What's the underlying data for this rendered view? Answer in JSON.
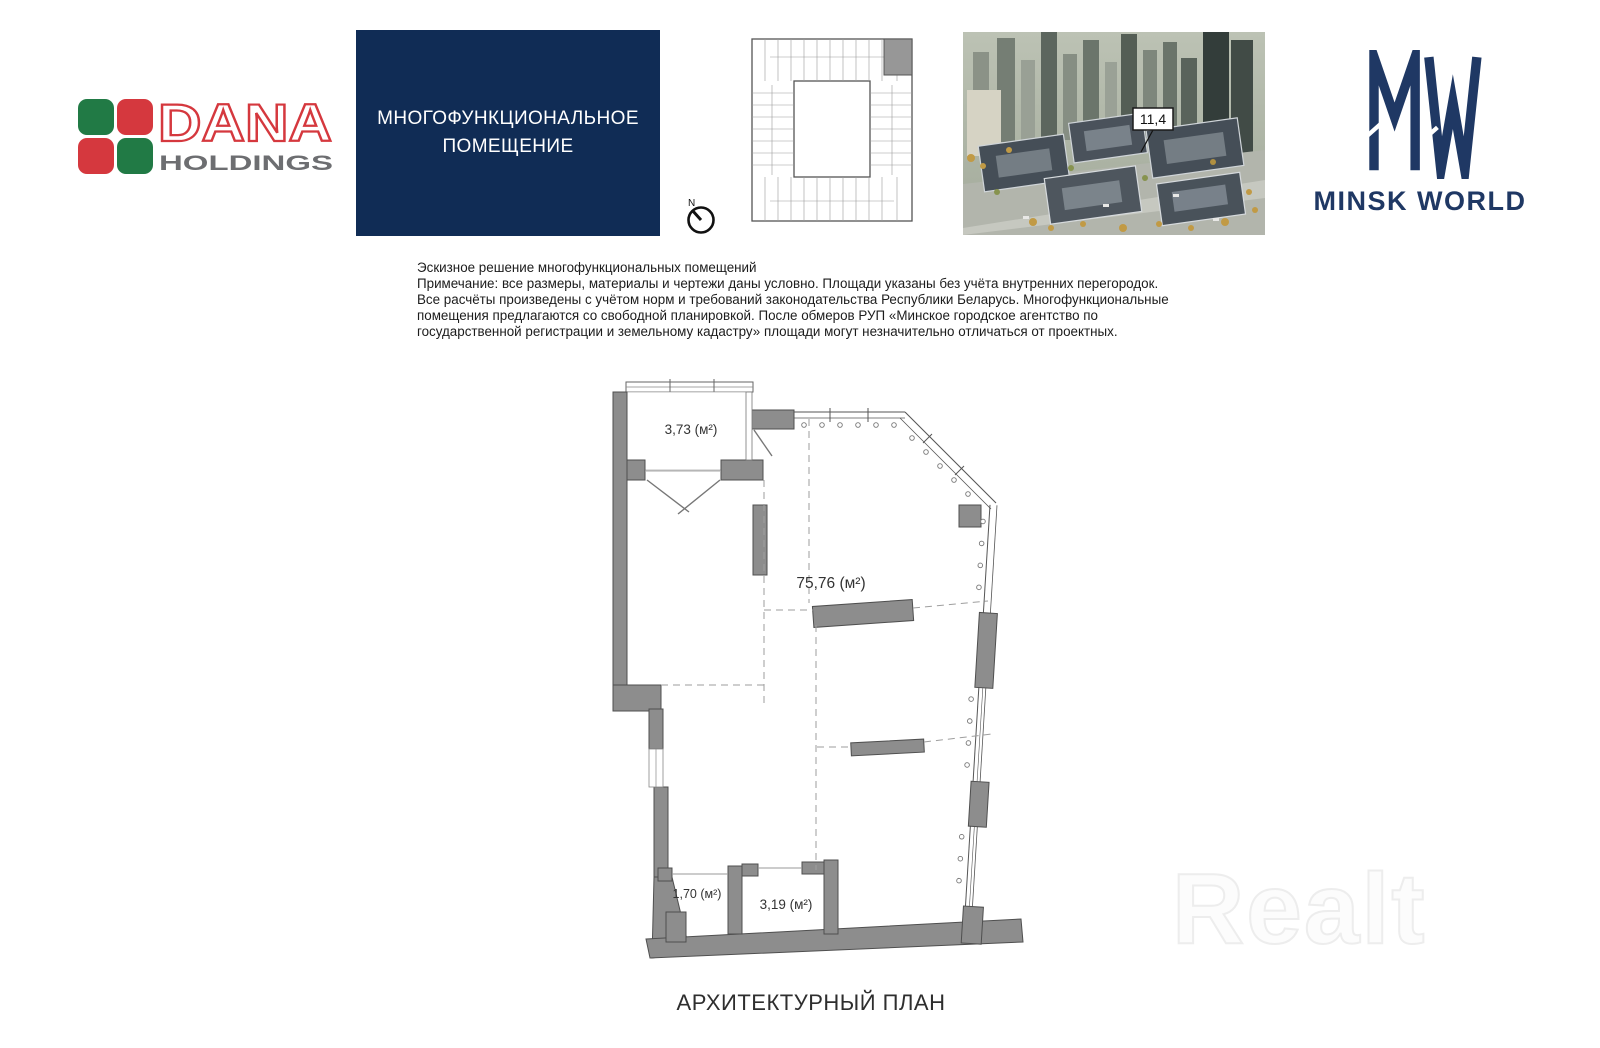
{
  "brand_left": {
    "name": "DANA",
    "subname": "HOLDINGS",
    "colors": {
      "green": "#217a45",
      "red": "#d5383e",
      "gray": "#6d6e71"
    }
  },
  "title_box": {
    "text": "МНОГОФУНКЦИОНАЛЬНОЕ ПОМЕЩЕНИЕ",
    "bg": "#102c55"
  },
  "key_plan": {
    "north_label": "N"
  },
  "render": {
    "building_label": "11,4"
  },
  "brand_right": {
    "name": "MINSK WORLD",
    "color": "#1f3864"
  },
  "notes": {
    "text": "Эскизное решение многофункциональных помещений\nПримечание: все размеры, материалы и чертежи даны условно. Площади указаны без учёта внутренних перегородок.\nВсе расчёты произведены с учётом норм и требований законодательства Республики Беларусь. Многофункциональные\nпомещения предлагаются со свободной планировкой. После обмеров РУП «Минское городское агентство по\nгосударственной регистрации и земельному кадастру» площади могут незначительно отличаться от проектных."
  },
  "plan": {
    "wall_color": "#8d8d8d",
    "rooms": [
      {
        "name": "balcony",
        "area_label": "3,73 (м²)"
      },
      {
        "name": "main-space",
        "area_label": "75,76 (м²)"
      },
      {
        "name": "storage-small",
        "area_label": "1,70 (м²)"
      },
      {
        "name": "storage-large",
        "area_label": "3,19 (м²)"
      }
    ]
  },
  "caption": {
    "text": "АРХИТЕКТУРНЫЙ ПЛАН"
  },
  "watermark": {
    "text": "Realt"
  }
}
